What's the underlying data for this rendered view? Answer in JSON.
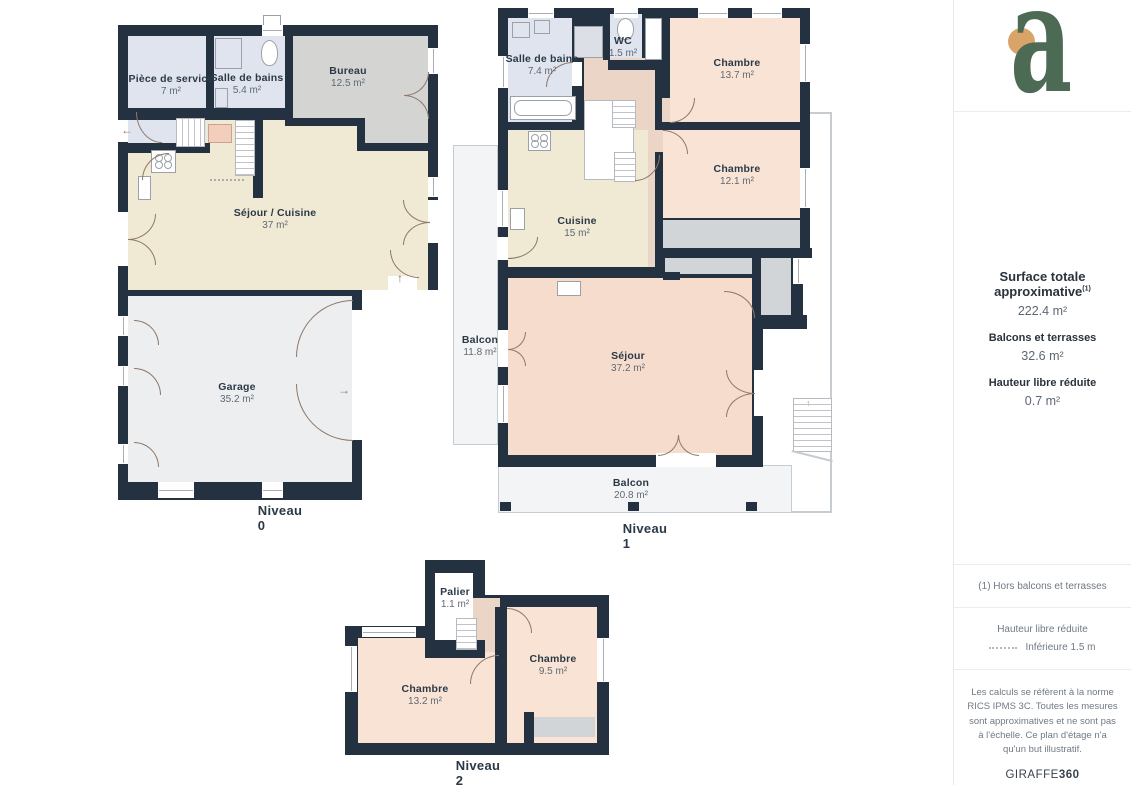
{
  "plans": [
    {
      "label": "Niveau 0",
      "rooms": [
        {
          "name": "Pièce de service",
          "area": "7 m²"
        },
        {
          "name": "Salle de bains",
          "area": "5.4 m²"
        },
        {
          "name": "Bureau",
          "area": "12.5 m²"
        },
        {
          "name": "Séjour / Cuisine",
          "area": "37 m²"
        },
        {
          "name": "Garage",
          "area": "35.2 m²"
        }
      ]
    },
    {
      "label": "Niveau 1",
      "rooms": [
        {
          "name": "Salle de bains",
          "area": "7.4 m²"
        },
        {
          "name": "WC",
          "area": "1.5 m²"
        },
        {
          "name": "Chambre",
          "area": "13.7 m²"
        },
        {
          "name": "Chambre",
          "area": "12.1 m²"
        },
        {
          "name": "Cuisine",
          "area": "15 m²"
        },
        {
          "name": "Séjour",
          "area": "37.2 m²"
        },
        {
          "name": "Balcon",
          "area": "11.8 m²"
        },
        {
          "name": "Balcon",
          "area": "20.8 m²"
        }
      ]
    },
    {
      "label": "Niveau 2",
      "rooms": [
        {
          "name": "Palier",
          "area": "1.1 m²"
        },
        {
          "name": "Chambre",
          "area": "13.2 m²"
        },
        {
          "name": "Chambre",
          "area": "9.5 m²"
        }
      ]
    }
  ],
  "sidebar": {
    "logo": {
      "letter": "a"
    },
    "surface": {
      "label": "Surface totale approximative",
      "sup": "(1)",
      "value": "222.4 m²"
    },
    "balconies": {
      "label": "Balcons et terrasses",
      "value": "32.6 m²"
    },
    "reduced_height": {
      "label": "Hauteur libre réduite",
      "value": "0.7 m²"
    },
    "footnote": "(1) Hors balcons et terrasses",
    "legend": {
      "title": "Hauteur libre réduite",
      "item": "Inférieure 1.5 m"
    },
    "disclaimer": "Les calculs se réfèrent à la norme RICS IPMS 3C. Toutes les mesures sont approximatives et ne sont pas à l'échelle. Ce plan d'étage n'a qu'un but illustratif.",
    "brand": {
      "normal": "GIRAFFE",
      "bold": "360"
    }
  },
  "icons": {
    "arrow_left": "←",
    "arrow_right": "→",
    "arrow_up": "↑"
  },
  "colors": {
    "wall": "#243140",
    "room_blue": "#dfe4ee",
    "room_gray": "#d4d5d2",
    "room_beige": "#f0e9d4",
    "room_peach": "#f8e3d4",
    "hall_peach": "#ead5c6",
    "balcony_fill": "#f3f4f5",
    "ledge_gray": "#d2d5d8",
    "logo_green": "#4d6a55",
    "logo_orange": "#d9a469"
  }
}
